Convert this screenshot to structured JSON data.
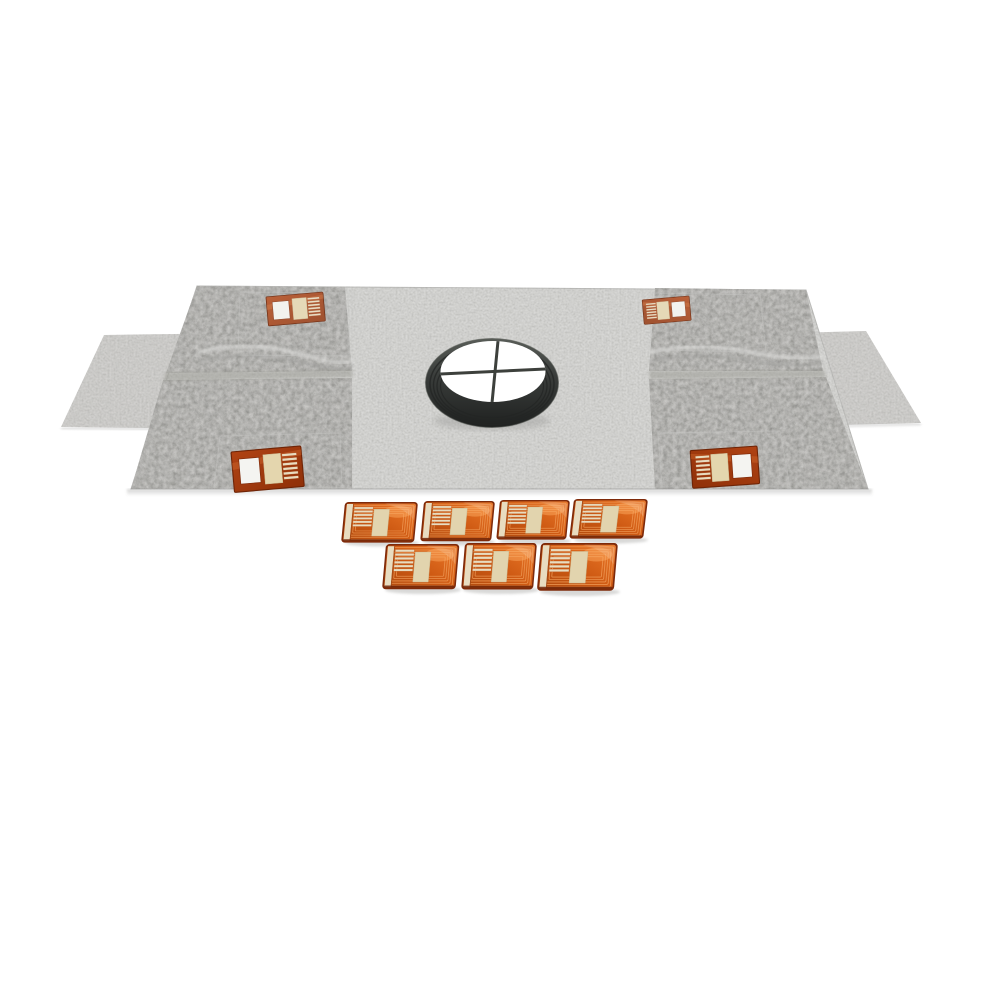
{
  "meta": {
    "kind": "product-photo",
    "subject": "waterproofing membrane kit with central drain seal collar, four corner sensor patches and seven flexible sensor pads",
    "background_color": "#ffffff"
  },
  "membrane": {
    "label": "gray non-woven membrane sheet",
    "field_color": "#dededc",
    "wing_color": "#d7d6d4",
    "corner_color": "#d2d1cf",
    "edge_color": "#c2c2c0",
    "wing_count": 2,
    "corner_section_count": 4
  },
  "drain_seal": {
    "label": "drain seal collar with cross grate",
    "ring_color": "#3a3d3b",
    "ring_dark_color": "#202221",
    "rib_color": "#232524",
    "hole_color": "#ffffff",
    "cross_color": "#3d403c"
  },
  "corner_patches": {
    "label": "corner sensor patch",
    "count": 4,
    "frame_color": "#a5400f",
    "frame_dark_color": "#6f2406",
    "window_color": "#f4f4f1",
    "label_color": "#e4d6ae",
    "trace_color": "#e8dcc0"
  },
  "sensor_pads": {
    "label": "flexible orange sensor pad",
    "count": 7,
    "rows": [
      4,
      3
    ],
    "border_color": "#7e2a0a",
    "body_color": "#cc5812",
    "highlight_color": "#f09c58",
    "coil_color": "#f09c58",
    "strip_color": "#e8dcc0",
    "pad_label_color": "#e2d4ae",
    "trace_color": "#e8dcc0"
  }
}
